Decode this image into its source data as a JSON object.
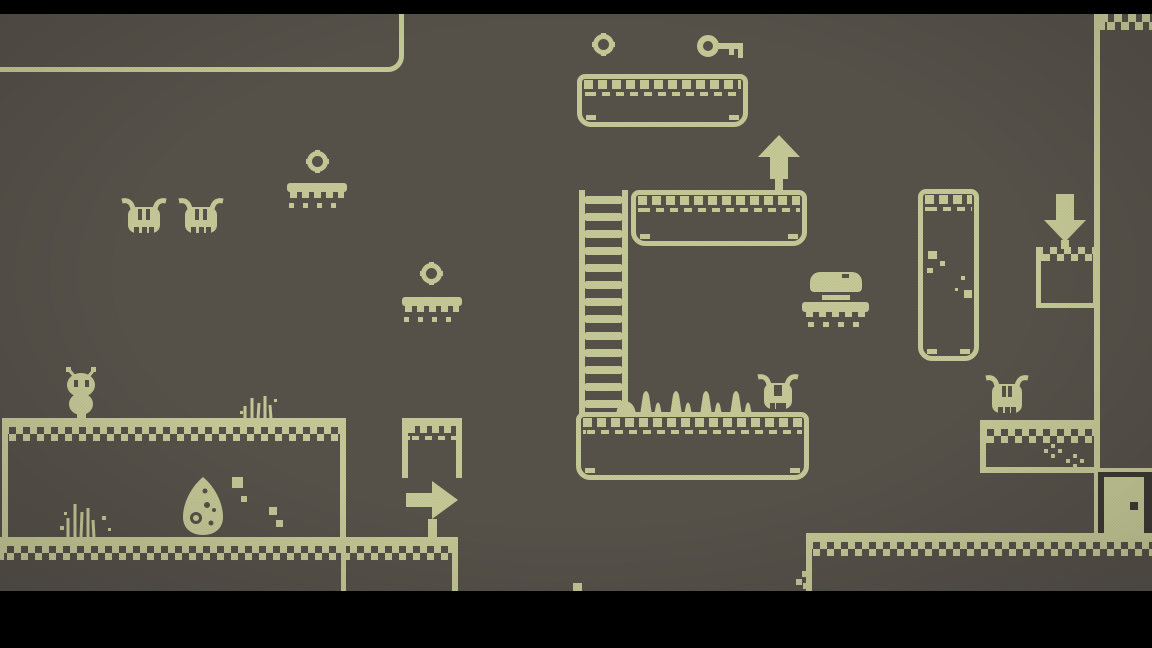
{
  "meta": {
    "scene_type": "pixel-platformer-level",
    "hud_text": ""
  },
  "colors": {
    "foreground": "#c7cb98",
    "background": "#57534b",
    "letterbox": "#000000",
    "dark_recess": "#3e3b36"
  },
  "viewport": {
    "width": 1152,
    "height": 648,
    "top_letterbox_height": 14,
    "bottom_letterbox_top": 591
  },
  "entities": [
    {
      "name": "room-outline-top-left",
      "type": "room-outline",
      "x": -60,
      "y": -80,
      "w": 464,
      "h": 152
    },
    {
      "name": "platform-key-ledge",
      "type": "platform-a",
      "x": 577,
      "y": 74,
      "w": 171,
      "h": 53
    },
    {
      "name": "coin-icon-1",
      "type": "coin",
      "x": 592,
      "y": 33,
      "w": 23,
      "h": 23
    },
    {
      "name": "key-icon",
      "type": "key",
      "x": 697,
      "y": 33,
      "w": 48,
      "h": 26
    },
    {
      "name": "spider-enemy-1",
      "type": "spider",
      "x": 119,
      "y": 197,
      "w": 50,
      "h": 41
    },
    {
      "name": "spider-enemy-2",
      "type": "spider",
      "x": 176,
      "y": 197,
      "w": 50,
      "h": 41
    },
    {
      "name": "coin-icon-2",
      "type": "coin",
      "x": 306,
      "y": 150,
      "w": 23,
      "h": 23
    },
    {
      "name": "floating-platform-1",
      "type": "float-platform",
      "x": 287,
      "y": 183,
      "w": 60,
      "h": 30
    },
    {
      "name": "coin-icon-3",
      "type": "coin",
      "x": 420,
      "y": 262,
      "w": 23,
      "h": 23
    },
    {
      "name": "floating-platform-2",
      "type": "float-platform",
      "x": 402,
      "y": 297,
      "w": 60,
      "h": 30
    },
    {
      "name": "ladder",
      "type": "ladder",
      "x": 579,
      "y": 190,
      "w": 49,
      "h": 226
    },
    {
      "name": "platform-mid",
      "type": "platform-a",
      "x": 631,
      "y": 190,
      "w": 176,
      "h": 56
    },
    {
      "name": "arrow-up-sign",
      "type": "arrow-up",
      "x": 756,
      "y": 133,
      "w": 46,
      "h": 60
    },
    {
      "name": "burger-item-platform",
      "type": "burger",
      "x": 802,
      "y": 270,
      "w": 67,
      "h": 62
    },
    {
      "name": "tall-column-platform",
      "type": "column",
      "x": 918,
      "y": 189,
      "w": 61,
      "h": 172
    },
    {
      "name": "arrow-down-sign",
      "type": "arrow-down",
      "x": 1042,
      "y": 192,
      "w": 46,
      "h": 57
    },
    {
      "name": "block-below-arrow",
      "type": "block",
      "x": 1036,
      "y": 247,
      "w": 62,
      "h": 61
    },
    {
      "name": "right-wall",
      "type": "vbar",
      "x": 1094,
      "y": 14,
      "w": 6,
      "h": 520
    },
    {
      "name": "checker-strip-top-right",
      "type": "checker-strip",
      "x": 1100,
      "y": 14,
      "w": 52,
      "h": 19
    },
    {
      "name": "spider-enemy-3",
      "type": "spider",
      "x": 755,
      "y": 373,
      "w": 46,
      "h": 41
    },
    {
      "name": "spikes-row",
      "type": "spikes",
      "x": 614,
      "y": 383,
      "w": 144,
      "h": 32
    },
    {
      "name": "platform-spikes",
      "type": "platform-a",
      "x": 576,
      "y": 412,
      "w": 233,
      "h": 68
    },
    {
      "name": "spider-enemy-4",
      "type": "spider",
      "x": 983,
      "y": 374,
      "w": 48,
      "h": 44
    },
    {
      "name": "ledge-right",
      "type": "ground",
      "x": 980,
      "y": 420,
      "w": 117,
      "h": 53,
      "left": true,
      "bottom": true
    },
    {
      "name": "sparkle-1",
      "type": "sparkle",
      "x": 1044,
      "y": 444,
      "w": 18,
      "h": 14
    },
    {
      "name": "sparkle-2",
      "type": "sparkle",
      "x": 1066,
      "y": 454,
      "w": 20,
      "h": 16
    },
    {
      "name": "floor-line-right",
      "type": "hbar",
      "x": 1098,
      "y": 468,
      "w": 54,
      "h": 6
    },
    {
      "name": "hollow-box-room",
      "type": "box-frame",
      "x": 2,
      "y": 418,
      "w": 344,
      "h": 122
    },
    {
      "name": "grass-tuft-top",
      "type": "grass",
      "x": 239,
      "y": 392,
      "w": 40,
      "h": 27
    },
    {
      "name": "grass-tuft-inside",
      "type": "grass2",
      "x": 58,
      "y": 498,
      "w": 56,
      "h": 40
    },
    {
      "name": "egg-rock",
      "type": "egg",
      "x": 181,
      "y": 477,
      "w": 44,
      "h": 58
    },
    {
      "name": "particles-1",
      "type": "particles",
      "x": 232,
      "y": 477,
      "w": 24,
      "h": 26
    },
    {
      "name": "particles-2",
      "type": "particles2",
      "x": 266,
      "y": 507,
      "w": 20,
      "h": 22
    },
    {
      "name": "player-character",
      "type": "player",
      "x": 60,
      "y": 366,
      "w": 44,
      "h": 54
    },
    {
      "name": "table-platform",
      "type": "table",
      "x": 402,
      "y": 418,
      "w": 60,
      "h": 60
    },
    {
      "name": "arrow-right-sign",
      "type": "arrow-right",
      "x": 404,
      "y": 479,
      "w": 58,
      "h": 60
    },
    {
      "name": "ground-bottom-left",
      "type": "ground",
      "x": 0,
      "y": 537,
      "w": 458,
      "h": 54,
      "right": true
    },
    {
      "name": "divider-line",
      "type": "vbar",
      "x": 341,
      "y": 546,
      "w": 5,
      "h": 45
    },
    {
      "name": "ground-bottom-right",
      "type": "ground",
      "x": 806,
      "y": 533,
      "w": 346,
      "h": 58,
      "left": true
    },
    {
      "name": "corner-steps",
      "type": "steps",
      "x": 796,
      "y": 571,
      "w": 14,
      "h": 20
    },
    {
      "name": "exit-door",
      "type": "door",
      "x": 1098,
      "y": 472,
      "w": 54,
      "h": 61
    },
    {
      "name": "pixel-debris",
      "type": "pixel",
      "x": 573,
      "y": 583,
      "w": 9,
      "h": 9
    }
  ]
}
